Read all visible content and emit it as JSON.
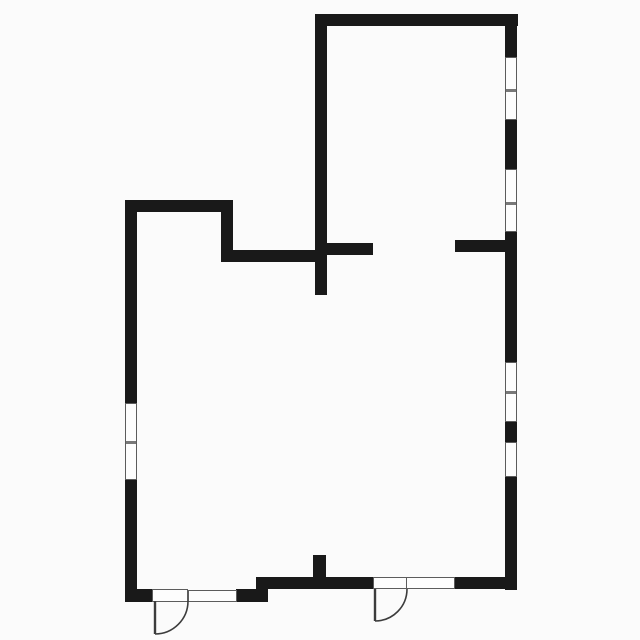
{
  "meta": {
    "drawing_type": "architectural floor plan",
    "rooms_visible": 2,
    "text_labels": [],
    "colors": {
      "background": "#fbfbfb",
      "wall": "#191919",
      "window_fill": "#fdfdfd",
      "window_border": "#5c5c5c",
      "window_divider": "#787878",
      "door_stroke": "#3c3c3c"
    }
  },
  "floorplan": {
    "canvas": {
      "width": 640,
      "height": 640
    },
    "walls": [
      {
        "name": "upper-room-top-wall",
        "x": 315,
        "y": 14,
        "w": 203,
        "h": 12
      },
      {
        "name": "right-exterior-wall",
        "x": 505,
        "y": 14,
        "w": 12,
        "h": 576
      },
      {
        "name": "upper-room-left-wall",
        "x": 315,
        "y": 14,
        "w": 12,
        "h": 281
      },
      {
        "name": "partition-stub-center",
        "x": 315,
        "y": 243,
        "w": 58,
        "h": 12
      },
      {
        "name": "partition-stub-right",
        "x": 455,
        "y": 240,
        "w": 50,
        "h": 12
      },
      {
        "name": "lower-room-top-wall",
        "x": 125,
        "y": 200,
        "w": 108,
        "h": 12
      },
      {
        "name": "lower-room-top-jog",
        "x": 221,
        "y": 200,
        "w": 12,
        "h": 62
      },
      {
        "name": "lower-room-top-connector",
        "x": 221,
        "y": 250,
        "w": 106,
        "h": 12
      },
      {
        "name": "left-exterior-wall",
        "x": 125,
        "y": 200,
        "w": 12,
        "h": 401
      },
      {
        "name": "bottom-wall-left-a",
        "x": 125,
        "y": 589,
        "w": 27,
        "h": 13
      },
      {
        "name": "bottom-wall-left-b",
        "x": 236,
        "y": 589,
        "w": 32,
        "h": 13
      },
      {
        "name": "bottom-wall-right-a",
        "x": 256,
        "y": 577,
        "w": 117,
        "h": 12
      },
      {
        "name": "bottom-wall-right-b",
        "x": 455,
        "y": 577,
        "w": 62,
        "h": 12
      },
      {
        "name": "bottom-center-stub",
        "x": 313,
        "y": 555,
        "w": 13,
        "h": 24
      }
    ],
    "windows": [
      {
        "name": "right-wall-upper-window-1",
        "x": 505,
        "y": 57,
        "w": 12,
        "h": 63,
        "orientation": "v",
        "dividers": [
          32
        ]
      },
      {
        "name": "right-wall-upper-window-2",
        "x": 505,
        "y": 169,
        "w": 12,
        "h": 63,
        "orientation": "v",
        "dividers": [
          33
        ]
      },
      {
        "name": "right-wall-lower-window-1",
        "x": 505,
        "y": 362,
        "w": 12,
        "h": 60,
        "orientation": "v",
        "dividers": [
          29
        ]
      },
      {
        "name": "right-wall-lower-window-2",
        "x": 505,
        "y": 442,
        "w": 12,
        "h": 35,
        "orientation": "v",
        "dividers": []
      },
      {
        "name": "left-wall-window",
        "x": 125,
        "y": 403,
        "w": 12,
        "h": 77,
        "orientation": "v",
        "dividers": [
          38
        ]
      },
      {
        "name": "bottom-left-window",
        "x": 188,
        "y": 590,
        "w": 49,
        "h": 12,
        "orientation": "h",
        "dividers": []
      },
      {
        "name": "bottom-right-window",
        "x": 406,
        "y": 577,
        "w": 49,
        "h": 12,
        "orientation": "h",
        "dividers": []
      }
    ],
    "doors": [
      {
        "name": "left-entry-door",
        "opening": {
          "x": 152,
          "y": 589,
          "w": 36,
          "h": 13
        },
        "leaf": {
          "x1": 155,
          "y1": 601,
          "x2": 155,
          "y2": 634
        },
        "arc": {
          "fromX": 155,
          "fromY": 634,
          "toX": 188,
          "toY": 601,
          "r": 33,
          "sweep": 0
        }
      },
      {
        "name": "right-entry-door",
        "opening": {
          "x": 373,
          "y": 577,
          "w": 34,
          "h": 12
        },
        "leaf": {
          "x1": 375,
          "y1": 589,
          "x2": 375,
          "y2": 621
        },
        "arc": {
          "fromX": 375,
          "fromY": 621,
          "toX": 407,
          "toY": 589,
          "r": 32,
          "sweep": 0
        }
      }
    ]
  }
}
